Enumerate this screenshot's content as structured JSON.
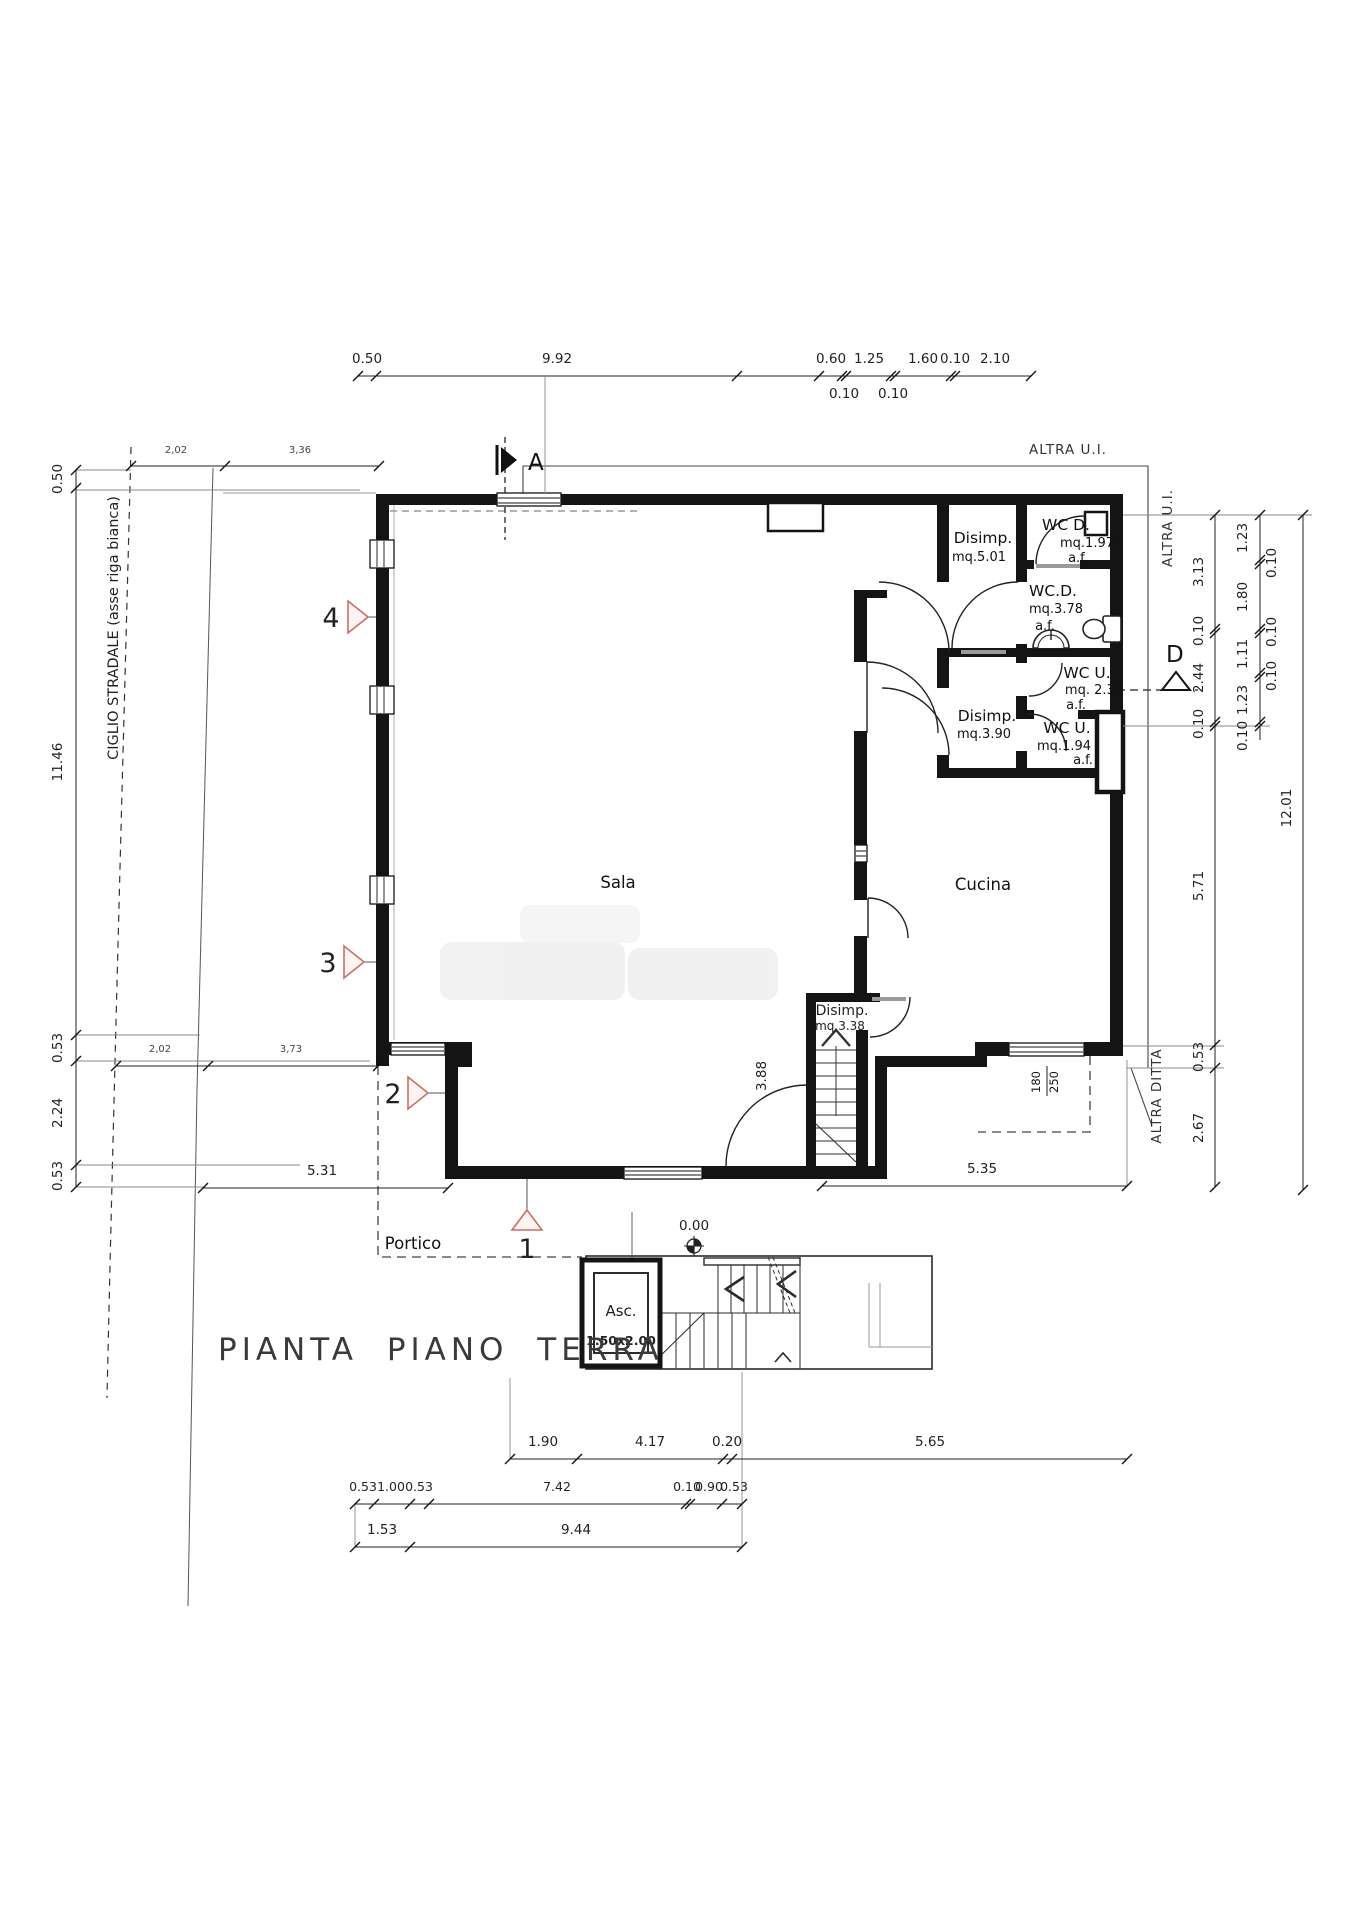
{
  "labels": {
    "title": "PIANTA PIANO TERRA",
    "ciglio": "CIGLIO STRADALE (asse riga bianca)",
    "altra_ui_top": "ALTRA U.I.",
    "altra_ui_right": "ALTRA U.I.",
    "altra_ditta": "ALTRA DITTA",
    "sala": "Sala",
    "cucina": "Cucina",
    "portico": "Portico",
    "level_zero": "0.00"
  },
  "rooms": {
    "disimp501": {
      "name": "Disimp.",
      "area": "mq.5.01"
    },
    "wc_d_197": {
      "name": "WC D.",
      "area": "mq.1.97",
      "af": "a.f."
    },
    "wc_d_378": {
      "name": "WC.D.",
      "area": "mq.3.78",
      "af": "a.f."
    },
    "wc_u_233": {
      "name": "WC U.",
      "area": "mq. 2.33",
      "af": "a.f."
    },
    "disimp390": {
      "name": "Disimp.",
      "area": "mq.3.90"
    },
    "wc_u_194": {
      "name": "WC U.",
      "area": "mq.1.94",
      "af": "a.f."
    },
    "disimp338": {
      "name": "Disimp.",
      "area": "mq.3.38"
    },
    "asc": {
      "name": "Asc.",
      "size": "1.50x2.00"
    }
  },
  "markers": {
    "section_a": "A",
    "section_d": "D",
    "v1": "1",
    "v2": "2",
    "v3": "3",
    "v4": "4"
  },
  "window_tag": {
    "w": "180",
    "h": "250"
  },
  "dims": {
    "top": [
      "0.50",
      "9.92",
      "0.60",
      "1.25",
      "1.60",
      "0.10",
      "2.10"
    ],
    "top_sub": [
      "0.10",
      "0.10"
    ],
    "left_v": [
      "0.50",
      "11.46",
      "0.53",
      "2.24",
      "0.53"
    ],
    "left_h_upper": [
      "2,02",
      "3,36"
    ],
    "left_h_lower": [
      "2,02",
      "3,73"
    ],
    "right_inner": [
      "3.13",
      "0.10",
      "2.44",
      "0.10",
      "5.71",
      "0.53",
      "2.67"
    ],
    "right_mid": [
      "1.23",
      "0.10",
      "1.80",
      "0.10",
      "1.11",
      "0.10",
      "1.23",
      "0.10"
    ],
    "right_total": "12.01",
    "bottom_a": [
      "5.31",
      "5.35"
    ],
    "bottom_b": [
      "1.90",
      "4.17",
      "0.20",
      "5.65"
    ],
    "bottom_c": [
      "0.53",
      "1.00",
      "0.53",
      "7.42",
      "0.10",
      "0.90",
      "0.53"
    ],
    "bottom_d": [
      "1.53",
      "9.44"
    ],
    "interior_sala": "3.88"
  }
}
